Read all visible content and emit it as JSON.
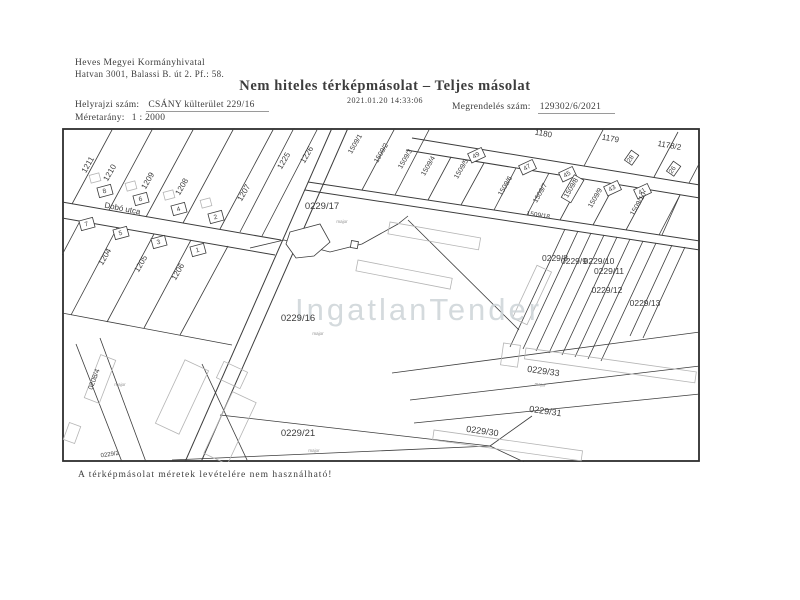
{
  "header": {
    "office_name": "Heves Megyei Kormányhivatal",
    "office_address": "Hatvan 3001, Balassi B. út 2.  Pf.: 58.",
    "title": "Nem hiteles térképmásolat – Teljes másolat",
    "datetime": "2021.01.20 14:33:06",
    "parcel_label": "Helyrajzi szám:",
    "parcel_value": "CSÁNY külterület 229/16",
    "scale_label": "Méretarány:",
    "scale_value": "1 : 2000",
    "order_label": "Megrendelés szám:",
    "order_value": "129302/6/2021"
  },
  "footer": {
    "disclaimer": "A térképmásolat méretek levételére nem használható!"
  },
  "watermark": {
    "text": "IngatlanTender",
    "color": "#cdd4d8"
  },
  "map": {
    "street_name": "Dobó utca",
    "ink_color": "#3c3c3c",
    "labels": [
      {
        "t": "1211",
        "x": 28,
        "y": 38,
        "r": -60,
        "s": 8
      },
      {
        "t": "1210",
        "x": 50,
        "y": 46,
        "r": -60,
        "s": 8
      },
      {
        "t": "1209",
        "x": 88,
        "y": 54,
        "r": -60,
        "s": 8
      },
      {
        "t": "1208",
        "x": 122,
        "y": 60,
        "r": -60,
        "s": 8
      },
      {
        "t": "1207",
        "x": 184,
        "y": 66,
        "r": -60,
        "s": 8
      },
      {
        "t": "1225",
        "x": 224,
        "y": 34,
        "r": -60,
        "s": 8
      },
      {
        "t": "1226",
        "x": 247,
        "y": 28,
        "r": -60,
        "s": 8
      },
      {
        "t": "1204",
        "x": 45,
        "y": 130,
        "r": -60,
        "s": 8
      },
      {
        "t": "1205",
        "x": 81,
        "y": 137,
        "r": -60,
        "s": 8
      },
      {
        "t": "1206",
        "x": 118,
        "y": 145,
        "r": -60,
        "s": 8
      },
      {
        "t": "0208/4",
        "x": 34,
        "y": 252,
        "r": -70,
        "s": 7
      },
      {
        "t": "Dobó utca",
        "x": 60,
        "y": 83,
        "r": 11,
        "s": 8
      },
      {
        "t": "8",
        "x": 43,
        "y": 65,
        "r": -15,
        "s": 6.5
      },
      {
        "t": "6",
        "x": 79,
        "y": 73,
        "r": -15,
        "s": 6.5
      },
      {
        "t": "4",
        "x": 117,
        "y": 83,
        "r": -15,
        "s": 6.5
      },
      {
        "t": "2",
        "x": 154,
        "y": 91,
        "r": -15,
        "s": 6.5
      },
      {
        "t": "7",
        "x": 25,
        "y": 98,
        "r": -15,
        "s": 6.5
      },
      {
        "t": "5",
        "x": 59,
        "y": 107,
        "r": -15,
        "s": 6.5
      },
      {
        "t": "3",
        "x": 97,
        "y": 116,
        "r": -15,
        "s": 6.5
      },
      {
        "t": "1",
        "x": 136,
        "y": 124,
        "r": -15,
        "s": 6.5
      },
      {
        "t": "1509/1",
        "x": 295,
        "y": 17,
        "r": -60,
        "s": 7
      },
      {
        "t": "1509/2",
        "x": 321,
        "y": 26,
        "r": -60,
        "s": 7
      },
      {
        "t": "1509/3",
        "x": 345,
        "y": 32,
        "r": -60,
        "s": 7
      },
      {
        "t": "1509/4",
        "x": 368,
        "y": 39,
        "r": -60,
        "s": 7
      },
      {
        "t": "1509/5",
        "x": 401,
        "y": 42,
        "r": -60,
        "s": 7
      },
      {
        "t": "1509/6",
        "x": 445,
        "y": 59,
        "r": -60,
        "s": 7
      },
      {
        "t": "1509/7",
        "x": 480,
        "y": 66,
        "r": -60,
        "s": 7
      },
      {
        "t": "1509/8",
        "x": 511,
        "y": 61,
        "r": -60,
        "s": 7
      },
      {
        "t": "1509/9",
        "x": 535,
        "y": 71,
        "r": -60,
        "s": 7
      },
      {
        "t": "1509/10",
        "x": 578,
        "y": 77,
        "r": -60,
        "s": 7
      },
      {
        "t": "49",
        "x": 415,
        "y": 29,
        "r": -30,
        "s": 6.5
      },
      {
        "t": "47",
        "x": 466,
        "y": 41,
        "r": -30,
        "s": 6.5
      },
      {
        "t": "45",
        "x": 506,
        "y": 48,
        "r": -30,
        "s": 6.5
      },
      {
        "t": "43",
        "x": 551,
        "y": 62,
        "r": -30,
        "s": 6.5
      },
      {
        "t": "41",
        "x": 581,
        "y": 65,
        "r": -30,
        "s": 6.5
      },
      {
        "t": "28",
        "x": 570,
        "y": 32,
        "r": -55,
        "s": 6.5
      },
      {
        "t": "26",
        "x": 612,
        "y": 43,
        "r": -55,
        "s": 6.5
      },
      {
        "t": "1180",
        "x": 481,
        "y": 8,
        "r": 10,
        "s": 8
      },
      {
        "t": "1179",
        "x": 548,
        "y": 13,
        "r": 10,
        "s": 8
      },
      {
        "t": "1178/2",
        "x": 607,
        "y": 20,
        "r": 10,
        "s": 8
      },
      {
        "t": "1509/18",
        "x": 476,
        "y": 89,
        "r": 9,
        "s": 6.5
      },
      {
        "t": "0229/17",
        "x": 260,
        "y": 81,
        "r": 0,
        "s": 9.5
      },
      {
        "t": "0229/16",
        "x": 236,
        "y": 193,
        "r": 0,
        "s": 9.5
      },
      {
        "t": "0229/21",
        "x": 236,
        "y": 308,
        "r": 0,
        "s": 9.5
      },
      {
        "t": "0229/33",
        "x": 481,
        "y": 246,
        "r": 8,
        "s": 9
      },
      {
        "t": "0229/31",
        "x": 483,
        "y": 286,
        "r": 8,
        "s": 9
      },
      {
        "t": "0229/30",
        "x": 420,
        "y": 306,
        "r": 8,
        "s": 9
      },
      {
        "t": "0229/8",
        "x": 493,
        "y": 133,
        "r": 0,
        "s": 8.5
      },
      {
        "t": "0229/9",
        "x": 512,
        "y": 136,
        "r": 0,
        "s": 8.5
      },
      {
        "t": "0229/10",
        "x": 537,
        "y": 136,
        "r": 0,
        "s": 8.5
      },
      {
        "t": "0229/11",
        "x": 547,
        "y": 146,
        "r": 0,
        "s": 8.5
      },
      {
        "t": "0229/12",
        "x": 545,
        "y": 165,
        "r": 0,
        "s": 8.5
      },
      {
        "t": "0229/13",
        "x": 583,
        "y": 178,
        "r": 0,
        "s": 8.5
      },
      {
        "t": "0229/2",
        "x": 48,
        "y": 328,
        "r": -8,
        "s": 6
      },
      {
        "t": "major",
        "x": 280,
        "y": 95,
        "r": 0,
        "s": 4.5,
        "c": "g"
      },
      {
        "t": "major",
        "x": 256,
        "y": 207,
        "r": 0,
        "s": 4.5,
        "c": "g"
      },
      {
        "t": "major",
        "x": 252,
        "y": 324,
        "r": 0,
        "s": 4.5,
        "c": "g"
      },
      {
        "t": "major",
        "x": 478,
        "y": 258,
        "r": 8,
        "s": 4.5,
        "c": "g"
      },
      {
        "t": "major",
        "x": 58,
        "y": 258,
        "r": 0,
        "s": 4.5,
        "c": "g"
      }
    ]
  }
}
